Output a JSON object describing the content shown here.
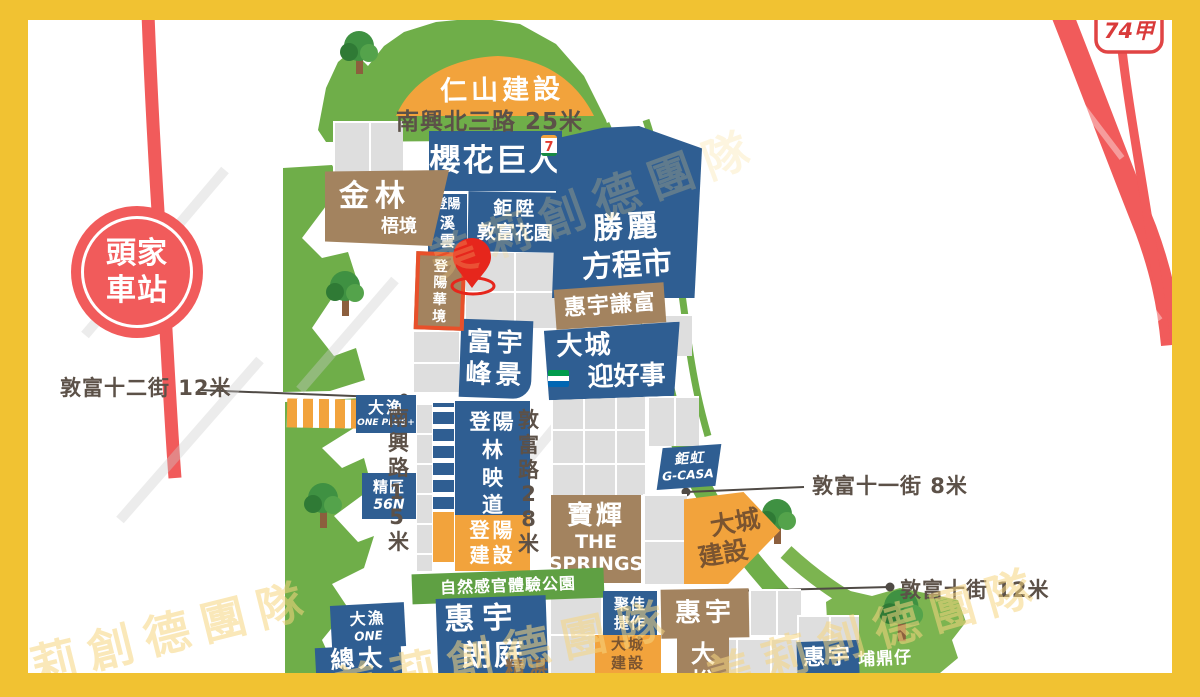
{
  "station": {
    "label": "頭家車站"
  },
  "expressway_sign": {
    "label": "74甲"
  },
  "roads": {
    "nanxing_n3": "南興北三路 25米",
    "dunfu_12st": "敦富十二街 12米",
    "nanxing": "南興路15米",
    "dunfu_rd": "敦富路28米",
    "dunfu_11st": "敦富十一街 8米",
    "dunfu_10st": "敦富十街 12米"
  },
  "park": {
    "label": "自然感官體驗公園"
  },
  "area": {
    "pudingzai": "埔鼎仔"
  },
  "blocks": {
    "renshan": {
      "label": "仁山建設"
    },
    "yinghua": {
      "label": "櫻花巨人"
    },
    "jinlin": {
      "line1": "金林",
      "line2": "梧境"
    },
    "dengyang_xiyun": {
      "line1": "登陽",
      "line2": "溪雲"
    },
    "jusheng": {
      "line1": "鉅陞",
      "line2": "敦富花園"
    },
    "dengyang_huajing": {
      "label": "登陽華境"
    },
    "fuyu": {
      "line1": "富宇",
      "line2": "峰景"
    },
    "shengli": {
      "line1": "勝麗",
      "line2": "方程市"
    },
    "huiyu_qianfu": {
      "label": "惠宇謙富"
    },
    "dacheng_ying": {
      "line1": "大城",
      "line2": "迎好事"
    },
    "dayu_oneplus": {
      "line1": "大漁",
      "line2": "ONE PLUS+"
    },
    "jingjiang": {
      "line1": "精匠",
      "line2": "56N"
    },
    "dengyang_lin": {
      "line1": "登陽",
      "line2": "林映道"
    },
    "dengyang_jianshe": {
      "line1": "登陽",
      "line2": "建設"
    },
    "baohui": {
      "line1": "寶輝",
      "line2": "THE",
      "line3": "SPRINGS"
    },
    "juhong": {
      "line1": "鉅虹",
      "line2": "G-CASA"
    },
    "dacheng_jianshe": {
      "line1": "大城",
      "line2": "建設"
    },
    "huiyu_langting": {
      "line1": "惠宇",
      "line2": "朗庭"
    },
    "dayu_one": {
      "line1": "大漁",
      "line2": "ONE"
    },
    "zongtai": {
      "line1": "總太",
      "line2": "織築"
    },
    "jujia": {
      "line1": "聚佳",
      "line2": "捷作"
    },
    "dacheng_jianshe2": {
      "line1": "大城",
      "line2": "建設"
    },
    "huiyu_dayue": {
      "line1": "惠宇",
      "line2": "大悅"
    },
    "jingzhan": {
      "label": "精湛"
    },
    "huiyu2": {
      "label": "惠宇"
    }
  },
  "icons": {
    "seven_eleven": "7",
    "familymart": "familymart-logo",
    "map_pin": "location-pin",
    "tree": "tree"
  },
  "watermark": {
    "text": "美莉創德團隊"
  },
  "colors": {
    "frame_yellow": "#F1C232",
    "rail_red": "#F15B5B",
    "block_blue": "#2F5E92",
    "block_brown": "#A3835F",
    "block_orange": "#F2A33C",
    "green": "#6FAE49",
    "highlight_outline": "#E8502A",
    "pin_red": "#E6261C"
  }
}
